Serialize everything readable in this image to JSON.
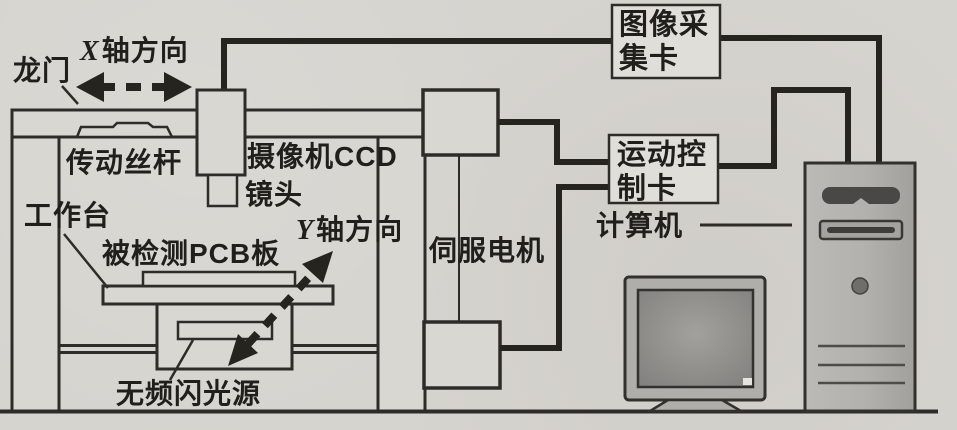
{
  "diagram": {
    "labels": {
      "gantry": "龙门",
      "x_axis_prefix": "X",
      "x_axis_suffix": "轴方向",
      "drive_screw": "传动丝杆",
      "camera_ccd": "摄像机CCD",
      "lens": "镜头",
      "worktable": "工作台",
      "pcb_board": "被检测PCB板",
      "y_axis_prefix": "Y",
      "y_axis_suffix": "轴方向",
      "light_source": "无频闪光源",
      "servo_motor": "伺服电机",
      "computer": "计算机"
    },
    "cards": {
      "image_capture": {
        "line1": "图像采",
        "line2": "集卡"
      },
      "motion_control": {
        "line1": "运动控",
        "line2": "制卡"
      }
    },
    "colors": {
      "paper_background": "#d6d4cf",
      "structure_line": "#2e2c29",
      "cable_line": "#26241f",
      "text": "#211f1c",
      "tower_fill": "#b5b3af",
      "monitor_screen": "#8f8d89"
    }
  }
}
